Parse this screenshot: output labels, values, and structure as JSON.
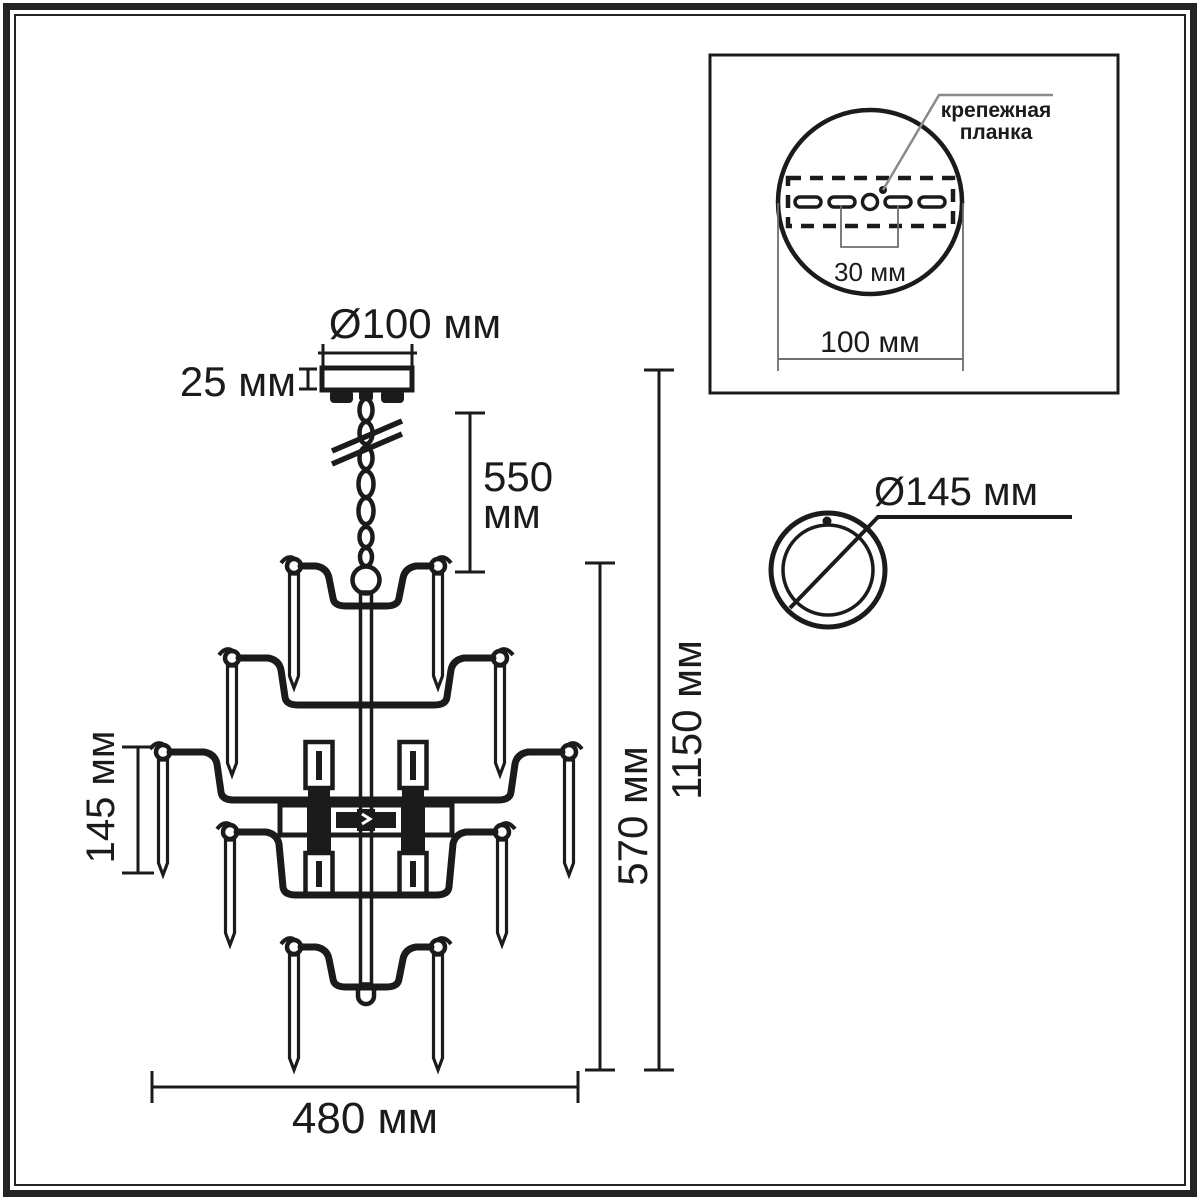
{
  "colors": {
    "ink": "#1b1b1b",
    "thin_dim": "#6f6f6f",
    "frame": "#242424",
    "background": "#ffffff"
  },
  "dimensions": {
    "canopy_diameter": "Ø100 мм",
    "canopy_height": "25 мм",
    "chain_length_line1": "550",
    "chain_length_line2": "мм",
    "total_height": "1150 мм",
    "body_height": "570 мм",
    "pendant_height": "145 мм",
    "body_width": "480 мм"
  },
  "mount_inset": {
    "label_line1": "крепежная",
    "label_line2": "планка",
    "hole_spacing": "30 мм",
    "plate_diameter": "100 мм"
  },
  "shade": {
    "diameter": "Ø145 мм"
  }
}
